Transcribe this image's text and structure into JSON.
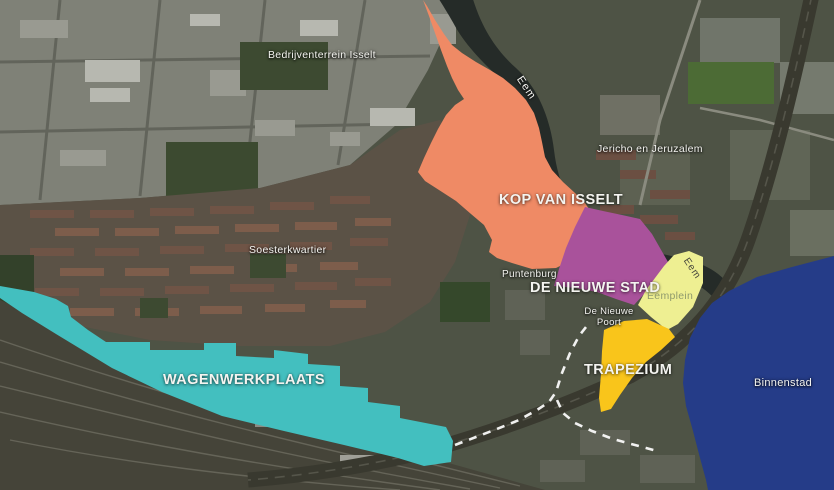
{
  "map": {
    "zones": [
      {
        "id": "kop-van-isselt",
        "label": "KOP VAN ISSELT",
        "color": "#EF8A65"
      },
      {
        "id": "de-nieuwe-stad",
        "label": "DE NIEUWE STAD",
        "color": "#A9529B"
      },
      {
        "id": "eemplein",
        "label": "Eemplein",
        "color": "#EEEF92"
      },
      {
        "id": "trapezium",
        "label": "TRAPEZIUM",
        "color": "#F9C51B"
      },
      {
        "id": "wagenwerkplaats",
        "label": "WAGENWERKPLAATS",
        "color": "#43BFBF"
      },
      {
        "id": "binnenstad",
        "label": "Binnenstad",
        "color": "#253C88"
      }
    ],
    "place_labels": {
      "bedrijventerrein_isselt": "Bedrijventerrein Isselt",
      "eem_river_north": "Eem",
      "jericho_en_jeruzalem": "Jericho en Jeruzalem",
      "soesterkwartier": "Soesterkwartier",
      "puntenburg": "Puntenburg",
      "de_nieuwe_poort": "De Nieuwe Poort",
      "eem_river_south": "Eem"
    }
  }
}
